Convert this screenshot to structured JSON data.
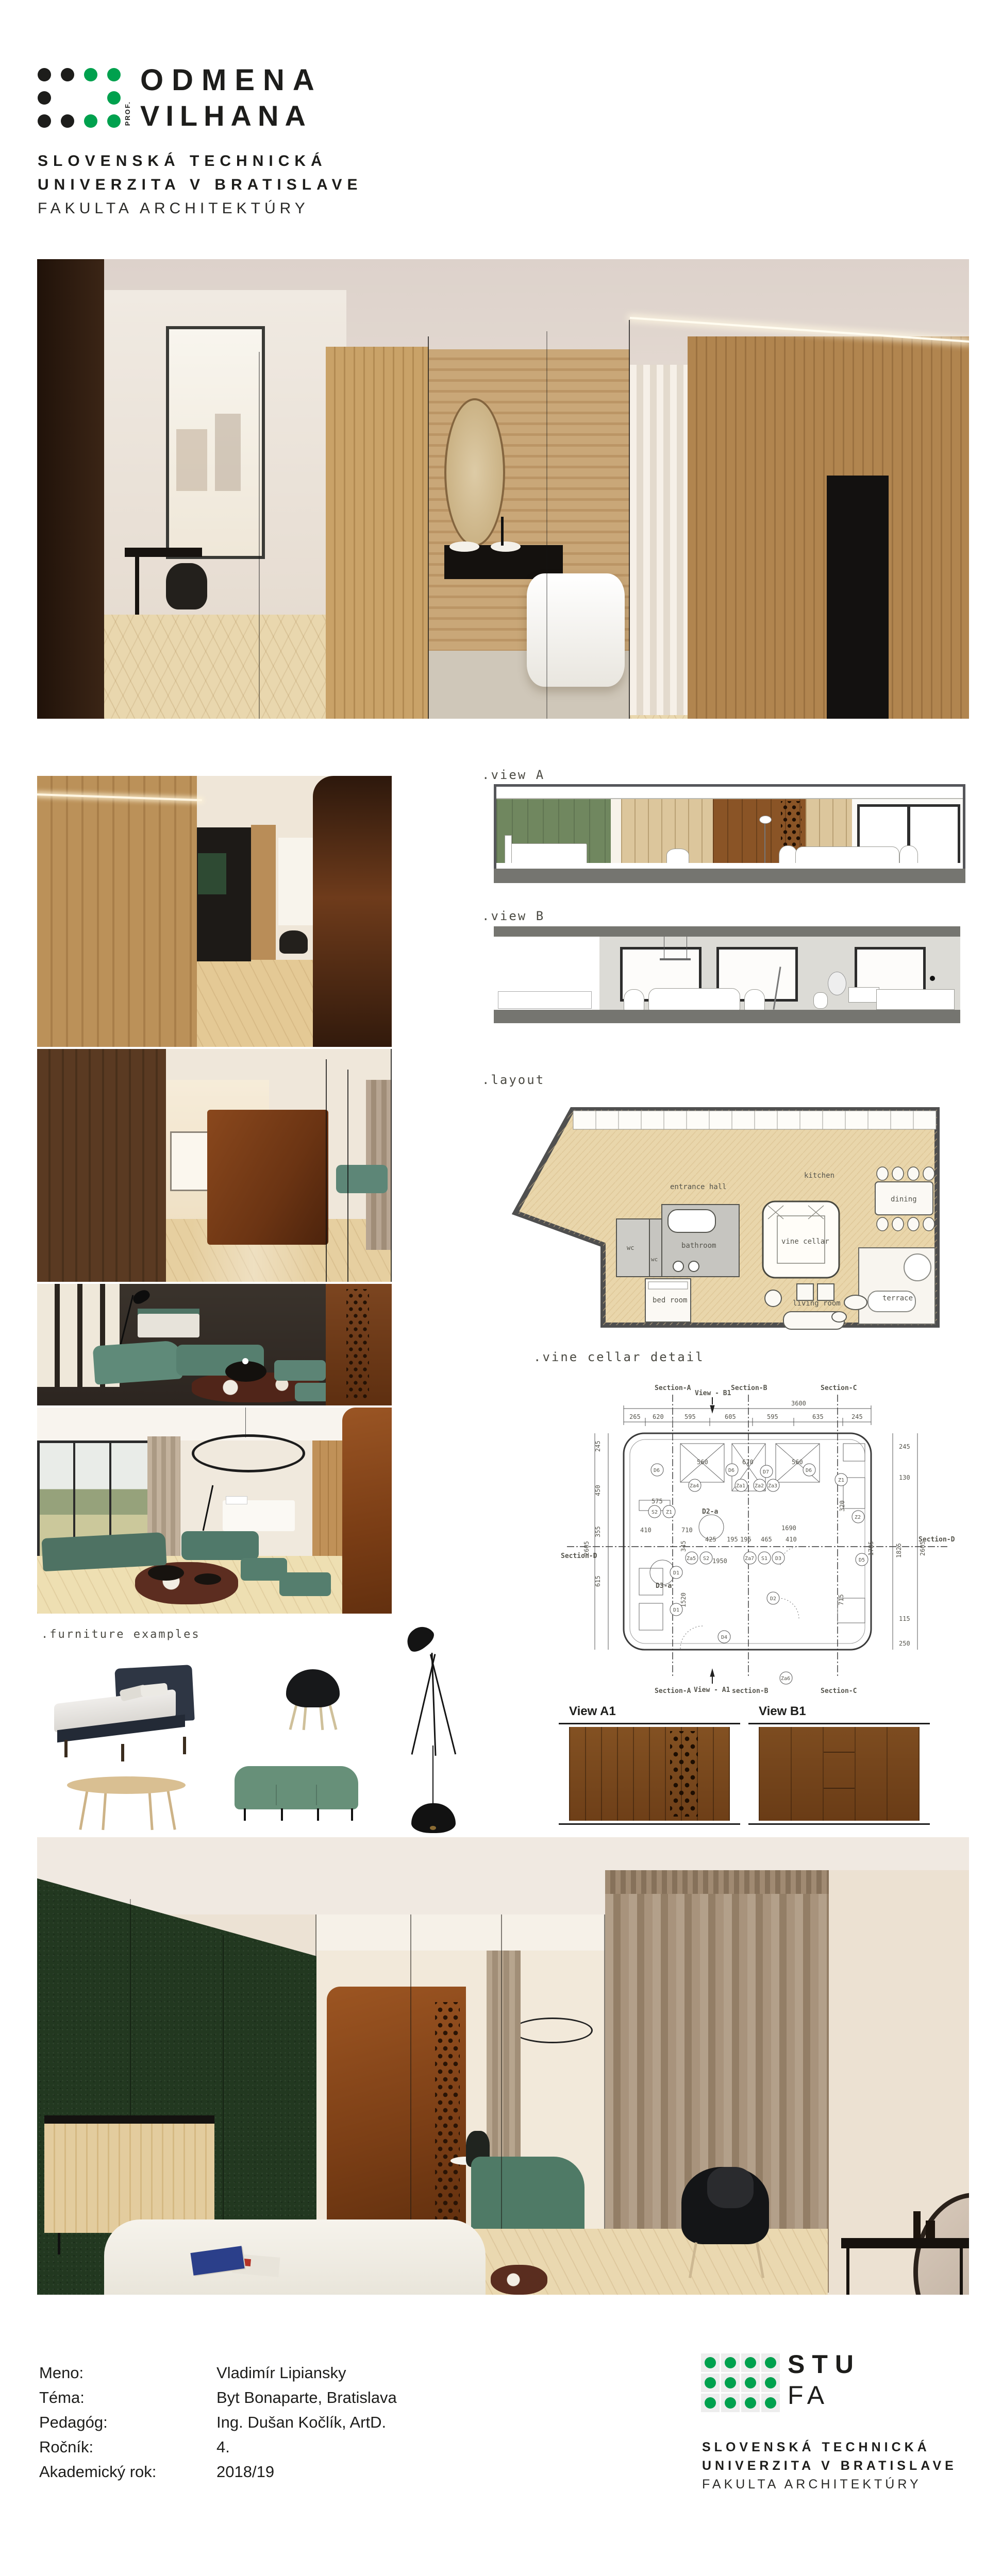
{
  "colors": {
    "green": "#00A14E",
    "black": "#1d1d1b",
    "corten": "#8a4a1e",
    "wood": "#c49a62",
    "panel_green": "#70875f",
    "sofa_green": "#679079",
    "wall_green": "#223820",
    "plan_floor": "#e9d6ab"
  },
  "branding": {
    "logo": {
      "word1": "ODMENA",
      "word2": "VILHANA",
      "prefix": "PROF."
    },
    "university": [
      "SLOVENSKÁ TECHNICKÁ",
      "UNIVERZITA V BRATISLAVE",
      "FAKULTA ARCHITEKTÚRY"
    ]
  },
  "labels": {
    "view_a": ".view A",
    "view_b": ".view B",
    "layout": ".layout",
    "wine_cellar": ".vine cellar detail",
    "furniture": ".furniture examples",
    "view_a1": "View A1",
    "view_b1": "View B1"
  },
  "floor_plan": {
    "rooms": [
      "entrance hall",
      "kitchen",
      "dining",
      "wc",
      "wc",
      "bathroom",
      "vine cellar",
      "bed room",
      "living room",
      "terrace"
    ]
  },
  "wine_detail": {
    "total": "3600",
    "top_dims": [
      "265",
      "620",
      "595",
      "605",
      "595",
      "635",
      "245"
    ],
    "left_dims": [
      "245",
      "450",
      "355",
      "615",
      "2605"
    ],
    "right_dims": [
      "245",
      "130",
      "1825",
      "115",
      "250",
      "2605"
    ],
    "inner_dims": [
      "575",
      "560",
      "670",
      "560",
      "410",
      "710",
      "1690",
      "425",
      "195",
      "195",
      "465",
      "410",
      "1950",
      "345",
      "1520",
      "715",
      "1785",
      "320"
    ],
    "sections": {
      "a": "Section-A",
      "b": "Section-B",
      "c": "Section-C",
      "d": "Section-D",
      "b_lower": "section-B"
    },
    "views": {
      "b1": "View - B1",
      "a1": "View - A1"
    },
    "tags": [
      "D6",
      "Za4",
      "D6",
      "Za1",
      "Za2",
      "Za3",
      "D7",
      "D6",
      "Z1",
      "S2",
      "Z1",
      "D2-a",
      "Z2",
      "Za5",
      "S2",
      "Za7",
      "S1",
      "D3",
      "D5",
      "D1",
      "D3-a",
      "D1",
      "D2",
      "D4",
      "Za6"
    ]
  },
  "footer": {
    "rows": [
      {
        "label": "Meno:",
        "value": "Vladimír Lipiansky"
      },
      {
        "label": "Téma:",
        "value": "Byt Bonaparte, Bratislava"
      },
      {
        "label": "Pedagóg:",
        "value": "Ing. Dušan Kočlík, ArtD."
      },
      {
        "label": "Ročník:",
        "value": "4."
      },
      {
        "label": "Akademický rok:",
        "value": "2018/19"
      }
    ]
  },
  "stu": {
    "acronym": "STU",
    "faculty": "FA",
    "university": [
      "SLOVENSKÁ TECHNICKÁ",
      "UNIVERZITA V BRATISLAVE",
      "FAKULTA ARCHITEKTÚRY"
    ]
  }
}
